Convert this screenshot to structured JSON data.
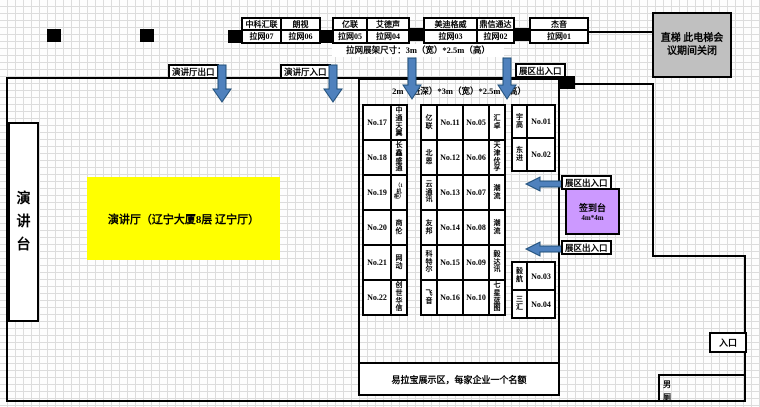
{
  "colors": {
    "arrow_fill": "#4f81bd",
    "arrow_stroke": "#1f4e79",
    "highlight_yellow": "#ffff00",
    "signin_purple": "#cc99ff",
    "elevator_gray": "#c0c0c0",
    "wall_black": "#000000"
  },
  "banner_stands": {
    "size_note": "拉网展架尺寸：3m（宽）*2.5m（高）",
    "items": [
      {
        "name": "中科汇联",
        "slot": "拉网07"
      },
      {
        "name": "朗视",
        "slot": "拉网06"
      },
      {
        "name": "亿联",
        "slot": "拉网05"
      },
      {
        "name": "艾德声",
        "slot": "拉网04"
      },
      {
        "name": "美迪格威",
        "slot": "拉网03"
      },
      {
        "name": "鼎信通达",
        "slot": "拉网02"
      },
      {
        "name": "杰音",
        "slot": "拉网01"
      }
    ]
  },
  "elevator": {
    "note": "直梯 此电梯会议期间关闭"
  },
  "lecture_hall": {
    "stage_label": "演讲台",
    "hall_label": "演讲厅（辽宁大厦8层 辽宁厅）",
    "exit_label": "演讲厅出口",
    "entrance_label": "演讲厅入口"
  },
  "booth_area": {
    "size_note": "2m（进深）*3m（宽）*2.5m（高）",
    "gate_label": "展区出入口",
    "left_rows": [
      {
        "no": "No.17",
        "company": "中通天翼"
      },
      {
        "no": "No.18",
        "company": "长鑫盛通"
      },
      {
        "no": "No.19",
        "company": "（1机柜）"
      },
      {
        "no": "No.20",
        "company": "商伦"
      },
      {
        "no": "No.21",
        "company": "网动"
      },
      {
        "no": "No.22",
        "company": "创世华信"
      }
    ],
    "middle_rows": [
      {
        "left_company": "亿联",
        "left_no": "No.11",
        "right_no": "No.05",
        "right_company": "汇卓"
      },
      {
        "left_company": "北恩",
        "left_no": "No.12",
        "right_no": "No.06",
        "right_company": "天津优孚"
      },
      {
        "left_company": "云通讯",
        "left_no": "No.13",
        "right_no": "No.07",
        "right_company": "潮流"
      },
      {
        "left_company": "友邦",
        "left_no": "No.14",
        "right_no": "No.08",
        "right_company": "潮流"
      },
      {
        "left_company": "科特尔",
        "left_no": "No.15",
        "right_no": "No.09",
        "right_company": "毅达讯"
      },
      {
        "left_company": "飞音",
        "left_no": "No.16",
        "right_no": "No.10",
        "right_company": "七星蓝图"
      }
    ],
    "right_top_rows": [
      {
        "company": "宇高",
        "no": "No.01"
      },
      {
        "company": "东进",
        "no": "No.02"
      }
    ],
    "right_bottom_rows": [
      {
        "company": "毅航",
        "no": "No.03"
      },
      {
        "company": "三汇",
        "no": "No.04"
      }
    ],
    "footer_note": "易拉宝展示区，每家企业一个名额"
  },
  "signin_desk": {
    "label": "签到台",
    "size": "4m*4m"
  },
  "entrance": {
    "label": "入口"
  },
  "restroom": {
    "label": "男厕"
  }
}
